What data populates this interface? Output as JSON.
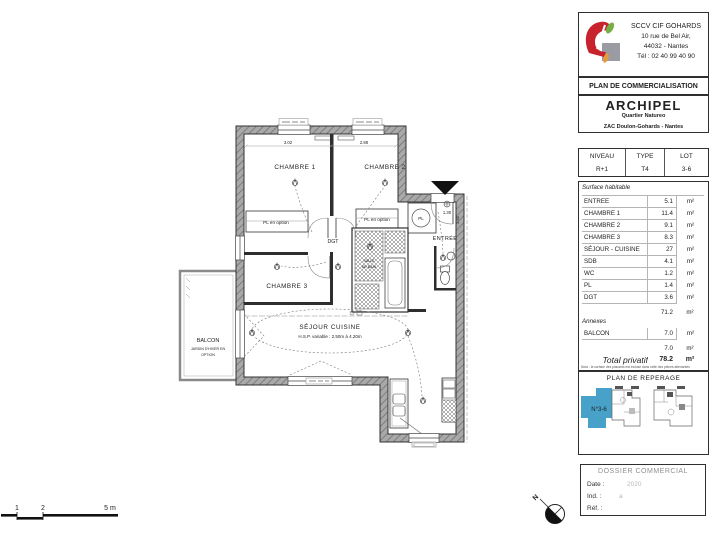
{
  "header": {
    "company_name": "SCCV CIF GOHARDS",
    "address_line1": "10 rue de Bel Air,",
    "address_line2": "44032 - Nantes",
    "phone": "Tél : 02 40 99 40 90"
  },
  "commercial_title": "PLAN DE COMMERCIALISATION",
  "project": {
    "name": "ARCHIPEL",
    "subtitle": "Quartier Natureo",
    "location": "ZAC Doulon-Gohards - Nantes"
  },
  "lot_table": {
    "headers": [
      "NIVEAU",
      "TYPE",
      "LOT"
    ],
    "values": [
      "R+1",
      "T4",
      "3-6"
    ]
  },
  "surface_table": {
    "section1_label": "Surface habitable",
    "rows": [
      {
        "label": "ENTREE",
        "value": "5.1",
        "unit": "m²"
      },
      {
        "label": "CHAMBRE 1",
        "value": "11.4",
        "unit": "m²"
      },
      {
        "label": "CHAMBRE 2",
        "value": "9.1",
        "unit": "m²"
      },
      {
        "label": "CHAMBRE 3",
        "value": "8.3",
        "unit": "m²"
      },
      {
        "label": "SÉJOUR - CUISINE",
        "value": "27",
        "unit": "m²"
      },
      {
        "label": "SDB",
        "value": "4.1",
        "unit": "m²"
      },
      {
        "label": "WC",
        "value": "1.2",
        "unit": "m²"
      },
      {
        "label": "PL",
        "value": "1.4",
        "unit": "m²"
      },
      {
        "label": "DGT",
        "value": "3.6",
        "unit": "m²"
      }
    ],
    "subtotal_habitable": {
      "value": "71.2",
      "unit": "m²"
    },
    "section2_label": "Annexes",
    "annex_rows": [
      {
        "label": "BALCON",
        "value": "7.0",
        "unit": "m²"
      }
    ],
    "subtotal_annexes": {
      "value": "7.0",
      "unit": "m²"
    },
    "total": {
      "label": "Total privatif",
      "value": "78.2",
      "unit": "m²"
    },
    "note": "Nota : la surface des placards est incluse dans celle des pièces attenantes"
  },
  "reperage": {
    "title": "PLAN DE REPERAGE",
    "lot_label": "N°3-6"
  },
  "dossier": {
    "title": "DOSSIER COMMERCIAL",
    "date_label": "Date :",
    "date_value": "2020",
    "ind_label": "Ind. :",
    "ind_value": "a",
    "ref_label": "Réf. :"
  },
  "plan": {
    "chambre1": "CHAMBRE 1",
    "chambre2": "CHAMBRE 2",
    "chambre3": "CHAMBRE 3",
    "dgt": "DGT",
    "entree": "ENTRÉE",
    "sejour": "SÉJOUR CUISINE",
    "sejour_hsp": "H.S.P. variable : 2.50m à 4.20m",
    "balcon": "BALCON",
    "balcon_option1": "JARDIN D'HIVER EN",
    "balcon_option2": "OPTION",
    "pl_option_left": "PL en option",
    "pl_option_right": "PL en option",
    "pl_entry": "PL",
    "sdb_line1": "SALLE",
    "sdb_line2": "DE BAIN",
    "dim_ch1": "3.02",
    "dim_ch2": "2.88",
    "dim_entry": "1.30",
    "dim_entry_v": "1.90"
  },
  "scale_bar": {
    "tick1": "1",
    "tick2": "2",
    "tick3": "5 m"
  },
  "compass": {
    "north": "N"
  },
  "colors": {
    "reperage_highlight": "#47a1c9",
    "logo_red": "#c8232c",
    "logo_green": "#74b043",
    "logo_orange": "#e39b3b",
    "logo_gray": "#9b9ba3"
  }
}
